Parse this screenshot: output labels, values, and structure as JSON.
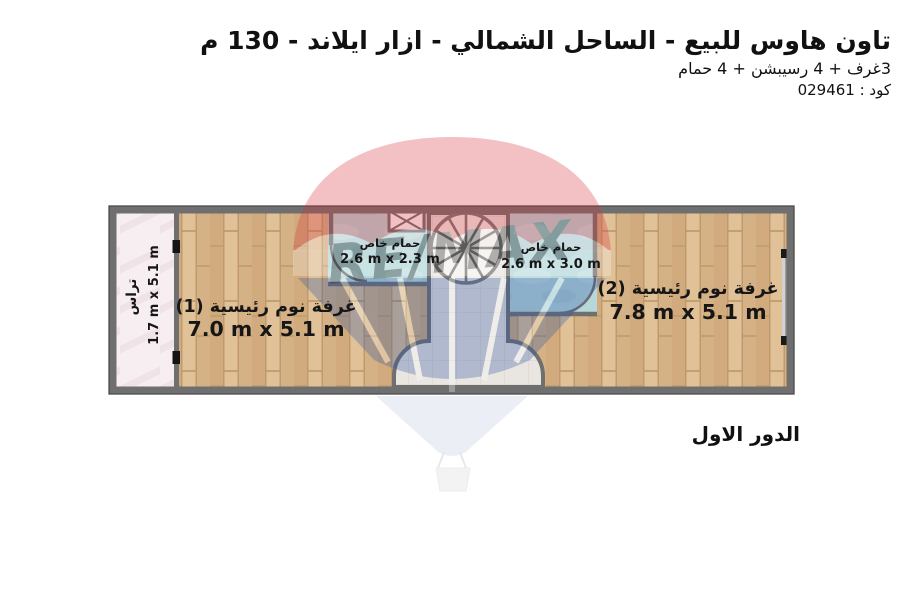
{
  "header": {
    "title": "تاون هاوس للبيع - الساحل الشمالي - ازار ايلاند - 130 م",
    "subtitle": "3غرف + 4 رسيبشن + 4 حمام",
    "code": "كود : 029461"
  },
  "plan": {
    "floor_label": "الدور الاول",
    "terrace": {
      "name": "تراس",
      "dims": "1.7 m x 5.1 m"
    },
    "bedroom1": {
      "name": "غرفة نوم رئيسية (1)",
      "dims": "7.0 m x 5.1 m"
    },
    "bedroom2": {
      "name": "غرفة نوم رئيسية (2)",
      "dims": "7.8 m x 5.1 m"
    },
    "bathroom1": {
      "name": "حمام خاص",
      "dims": "2.6 m x 2.3 m"
    },
    "bathroom2": {
      "name": "حمام خاص",
      "dims": "2.6 m x 3.0 m"
    }
  },
  "watermark": {
    "brand": "RE/MAX"
  },
  "colors": {
    "wall": "#6f6f6f",
    "wood_floor": "#d8b78c",
    "bathroom_floor": "#b6d8db",
    "terrace_floor": "#f7eef1",
    "stair_tile": "#e9e6e1",
    "watermark_red": "#d8353f",
    "watermark_blue": "#2f55a4"
  }
}
